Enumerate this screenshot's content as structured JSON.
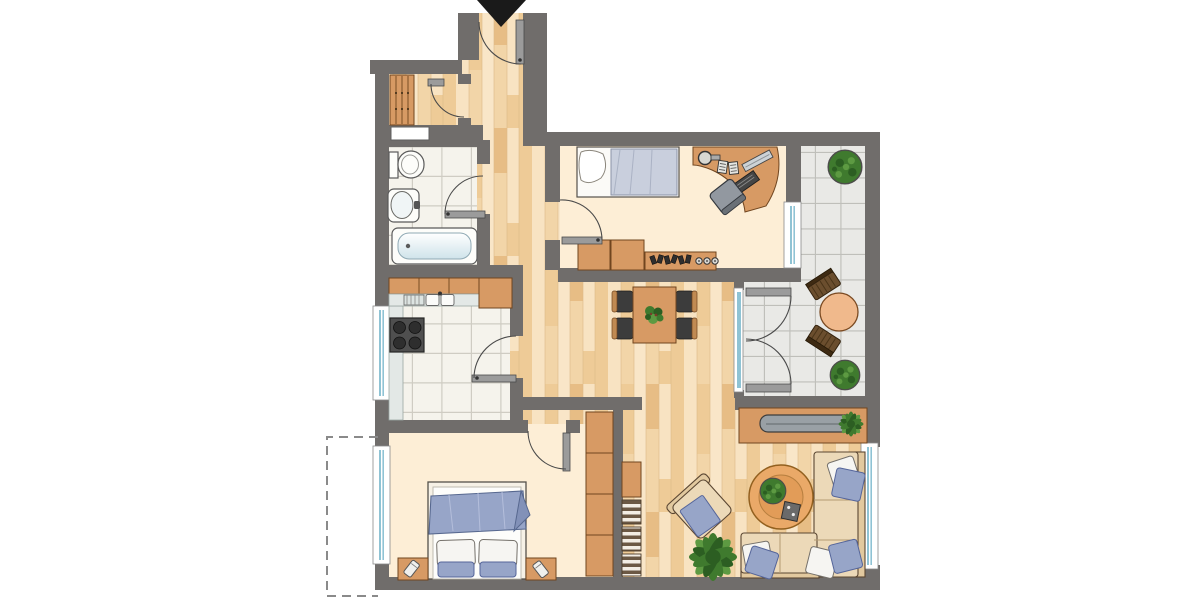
{
  "meta": {
    "label": "apartment-floor-plan",
    "width": 1200,
    "height": 600
  },
  "colors": {
    "wall": "#706d6b",
    "bedroomFloor": "#fdeed6",
    "bathTile": "#f5f3ec",
    "bathGrout": "#cfccc3",
    "balconyTile": "#e9e9e6",
    "balconyGrout": "#bfbfba",
    "furnitureWood": "#d79a64",
    "woodDark": "#70451f",
    "sofa": "#ecd9b8",
    "sofaBack": "#e2c99f",
    "accentBlue": "#97a5c8",
    "blanketLight": "#c9cfdd",
    "glass": "#8fc3d4",
    "plantDark": "#3f7a2e",
    "plantLight": "#5d9a42",
    "plantDeep": "#2c5e22",
    "counter": "#e3e8e6",
    "stove": "#4f4f4f",
    "tvGray": "#99a0a5",
    "terracotta": "#f0b98c",
    "balconyWood": "#6b4e2e",
    "parquetBase": "#f3d7ad",
    "parquetLight": "#f8e3c2",
    "parquetMid": "#eecb97",
    "parquetDark": "#e7bd85",
    "parquetPale": "#f2d5a8",
    "parquetCream": "#f9e6c8"
  },
  "rooms": [
    {
      "id": "entry-hall"
    },
    {
      "id": "storage-nook"
    },
    {
      "id": "bathroom"
    },
    {
      "id": "kitchen"
    },
    {
      "id": "bedroom-top"
    },
    {
      "id": "dining-area"
    },
    {
      "id": "living-room"
    },
    {
      "id": "bedroom-bottom"
    },
    {
      "id": "balcony"
    },
    {
      "id": "optional-area-dashed"
    }
  ],
  "furniture": [
    "entrance-arrow",
    "entry-door",
    "slatted-wardrobe",
    "wall-niche",
    "toilet",
    "washbasin",
    "bathtub",
    "kitchen-cabinets",
    "kitchen-sink",
    "dish-rack",
    "stove",
    "side-counter",
    "single-bed",
    "desk",
    "desk-chair",
    "desk-lamp",
    "dresser",
    "sideboard-knobs",
    "dining-table",
    "dining-chairs",
    "table-plant",
    "tv-lowboard",
    "tv",
    "l-sofa",
    "throw-pillows",
    "armchair",
    "coffee-table",
    "floor-plant",
    "double-bed",
    "nightstand-left",
    "nightstand-right",
    "built-in-wardrobe",
    "bookshelf",
    "balcony-table",
    "balcony-chairs",
    "potted-plant-top",
    "potted-plant-bottom",
    "window-kitchen",
    "window-bedroom-bottom",
    "window-bedroom-top",
    "window-living",
    "french-doors"
  ]
}
